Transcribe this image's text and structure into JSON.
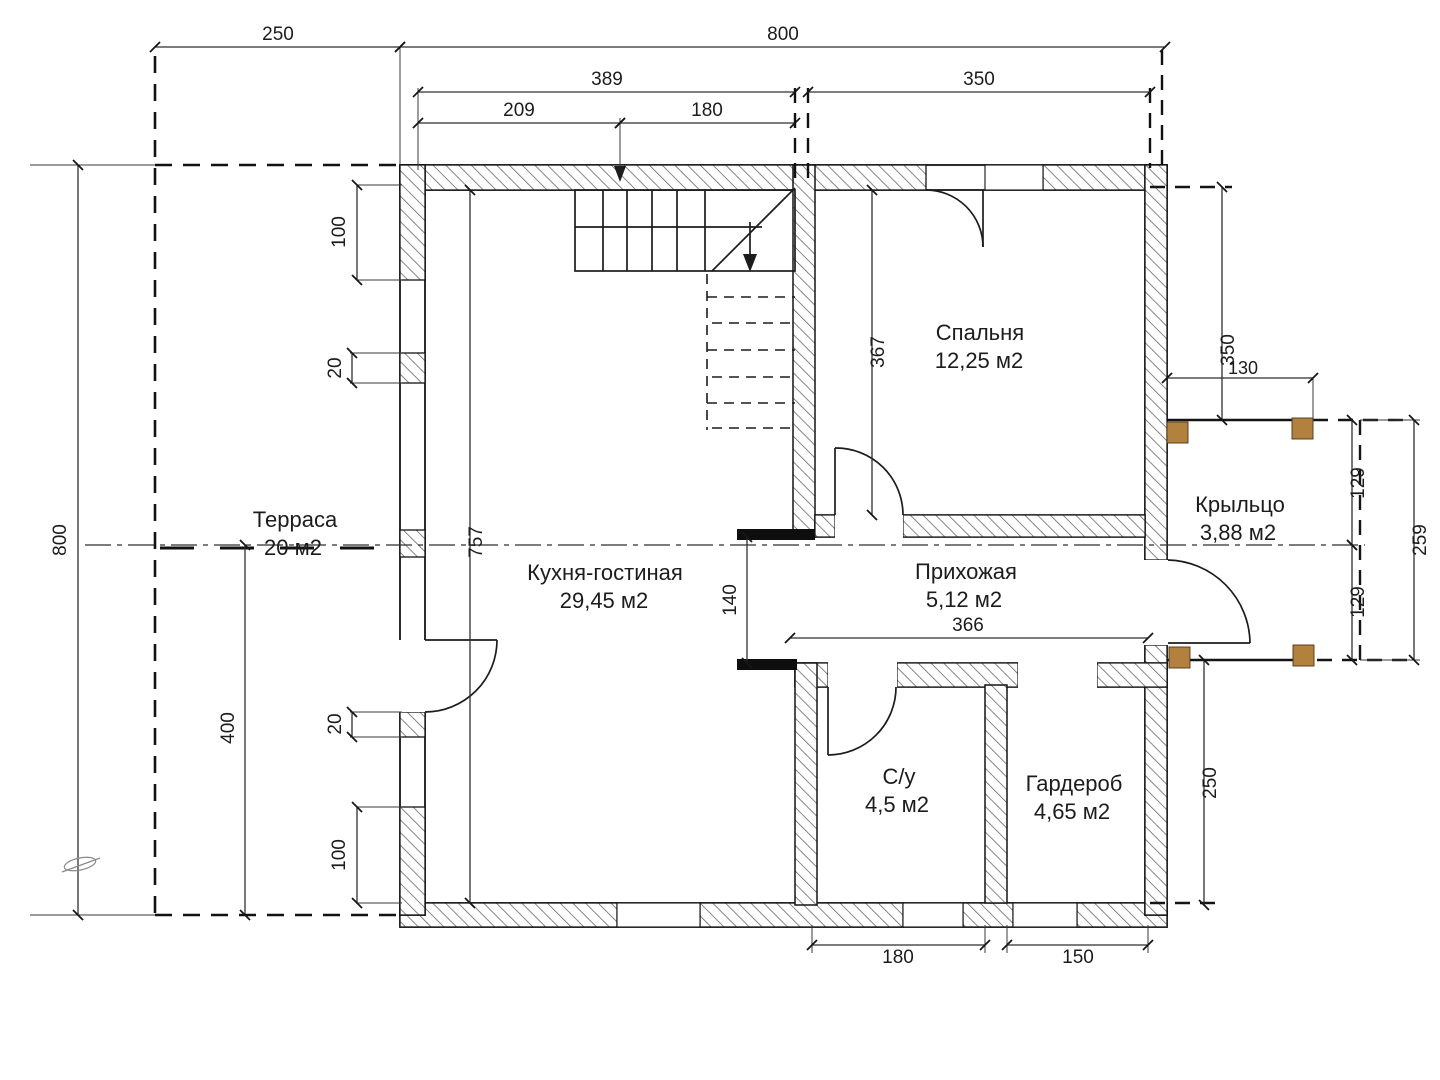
{
  "plan_title": "Floor plan — 1st floor",
  "rooms": {
    "terrace": {
      "name": "Терраса",
      "area": "20 м2"
    },
    "kitchen": {
      "name": "Кухня-гостиная",
      "area": "29,45 м2"
    },
    "bedroom": {
      "name": "Спальня",
      "area": "12,25 м2"
    },
    "hallway": {
      "name": "Прихожая",
      "area": "5,12 м2"
    },
    "bathroom": {
      "name": "С/у",
      "area": "4,5  м2"
    },
    "wardrobe": {
      "name": "Гардероб",
      "area": "4,65  м2"
    },
    "porch": {
      "name": "Крыльцо",
      "area": "3,88  м2"
    }
  },
  "dims": {
    "top_terrace": "250",
    "top_total": "800",
    "top_inner": "389",
    "top_bedroom": "350",
    "top_stair_left": "209",
    "top_stair_right": "180",
    "left_total": "800",
    "left_lower": "400",
    "left_pier_top": "100",
    "left_pier_20a": "20",
    "left_pier_20b": "20",
    "left_pier_bottom": "100",
    "kitchen_height": "757",
    "bedroom_height": "367",
    "hall_height": "140",
    "hall_width": "366",
    "bath_width": "180",
    "wardrobe_width": "150",
    "porch_drop": "350",
    "porch_width": "130",
    "porch_half_a": "129",
    "porch_half_b": "129",
    "porch_total": "259",
    "right_lower": "250"
  },
  "colors": {
    "line": "#141414",
    "dim": "#3a3a3a",
    "post": "#b3813e",
    "background": "#ffffff"
  }
}
